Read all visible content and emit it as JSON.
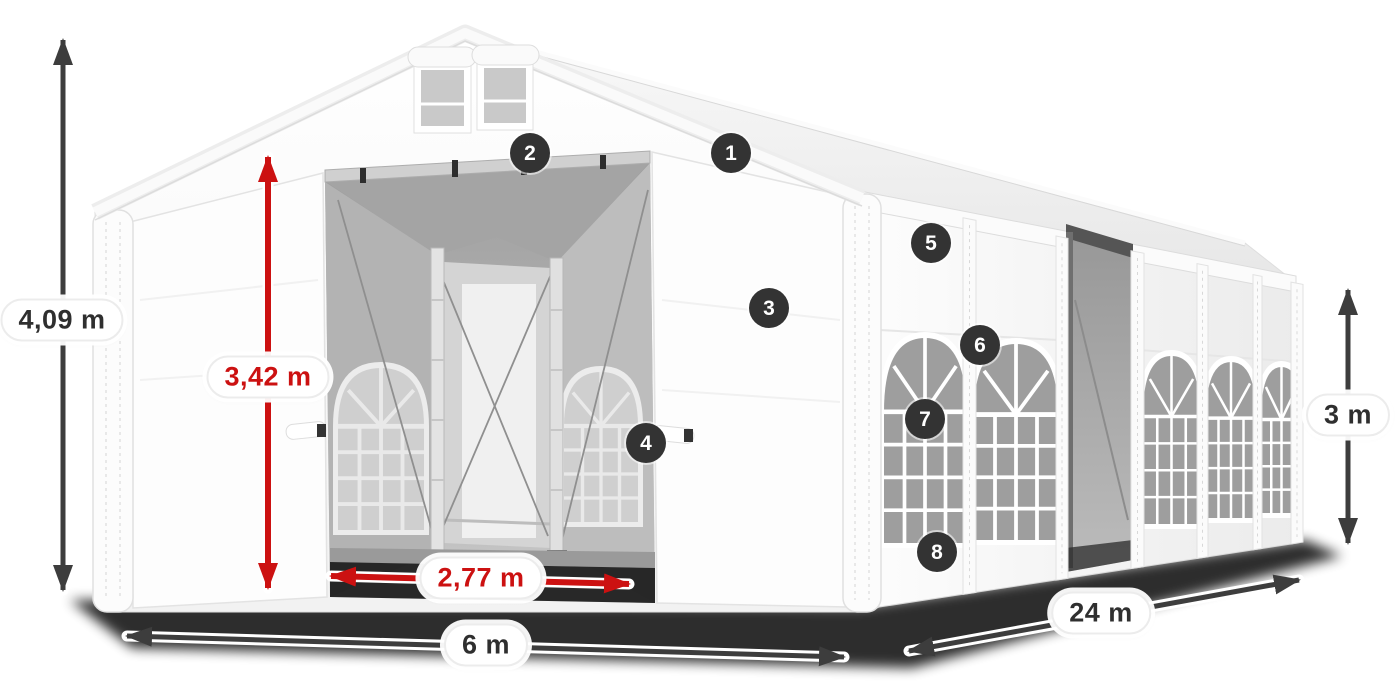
{
  "scene": {
    "description": "white marquee party tent with open gable entrance, numbered part callouts and dimension arrows"
  },
  "diagram": {
    "colors": {
      "badge_bg": "#333333",
      "arrow_dark": "#3d3d3d",
      "arrow_red": "#cc1111",
      "label_dark": "#2f2f2f",
      "pill_bg": "#ffffff",
      "pill_border": "#ececec"
    },
    "dimensions": [
      {
        "id": "total-height",
        "label": "4,09 m",
        "color": "dark",
        "orientation": "vertical"
      },
      {
        "id": "entrance-height",
        "label": "3,42 m",
        "color": "red",
        "orientation": "vertical"
      },
      {
        "id": "entrance-width",
        "label": "2,77 m",
        "color": "red",
        "orientation": "horizontal"
      },
      {
        "id": "tent-width",
        "label": "6 m",
        "color": "dark",
        "orientation": "horizontal"
      },
      {
        "id": "tent-length",
        "label": "24 m",
        "color": "dark",
        "orientation": "diagonal"
      },
      {
        "id": "side-height",
        "label": "3 m",
        "color": "dark",
        "orientation": "vertical"
      }
    ],
    "callouts": [
      "1",
      "2",
      "3",
      "4",
      "5",
      "6",
      "7",
      "8"
    ]
  }
}
